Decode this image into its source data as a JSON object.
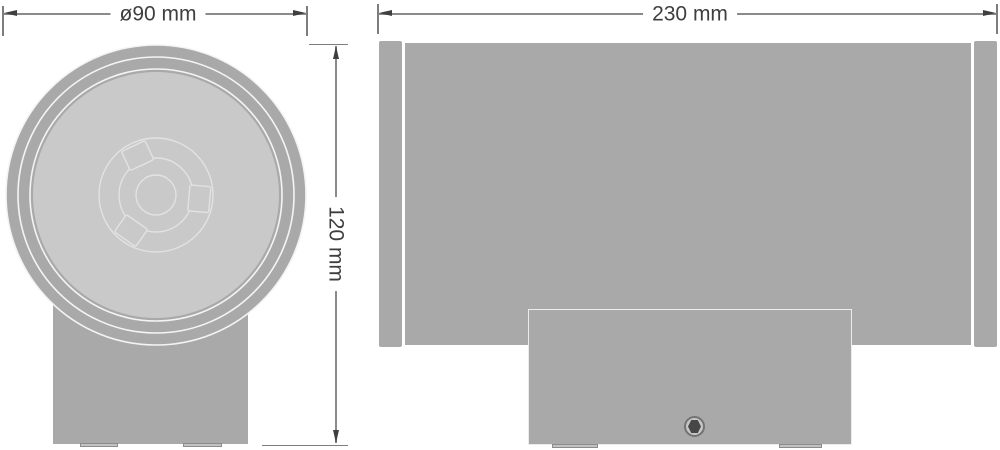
{
  "diagram": {
    "kind": "technical-dimension-drawing",
    "subject": "cylindrical wall-mounted luminaire, two orthographic views",
    "views": {
      "front": {
        "name": "front view (round luminaire head on wall bracket)",
        "diameter_dimension": {
          "label": "ø90 mm",
          "value": 90,
          "unit": "mm"
        },
        "height_dimension": {
          "label": "120 mm",
          "value": 120,
          "unit": "mm"
        },
        "features": [
          "outer bezel ring",
          "two concentric bezel lines",
          "diffuser face",
          "inner lamp module outline with three bayonet tabs",
          "mounting column",
          "two base feet"
        ]
      },
      "side": {
        "name": "side view (horizontal cylinder body with wall-mount bracket)",
        "width_dimension": {
          "label": "230 mm",
          "value": 230,
          "unit": "mm"
        },
        "features": [
          "left end cap",
          "main cylinder body",
          "right end cap",
          "wall-mount bracket",
          "hex screw",
          "two base feet"
        ]
      }
    },
    "colors": {
      "background": "#ffffff",
      "body_gray": "#a9a9a9",
      "face_light_gray": "#c9c9c9",
      "bezel_line": "#f4f4f4",
      "module_outline": "#e2e2e2",
      "dimension_line": "#8a8a8a",
      "dimension_arrow": "#3f3f3f",
      "dimension_text": "#3e3e3e",
      "screw_dark": "#474747"
    }
  }
}
